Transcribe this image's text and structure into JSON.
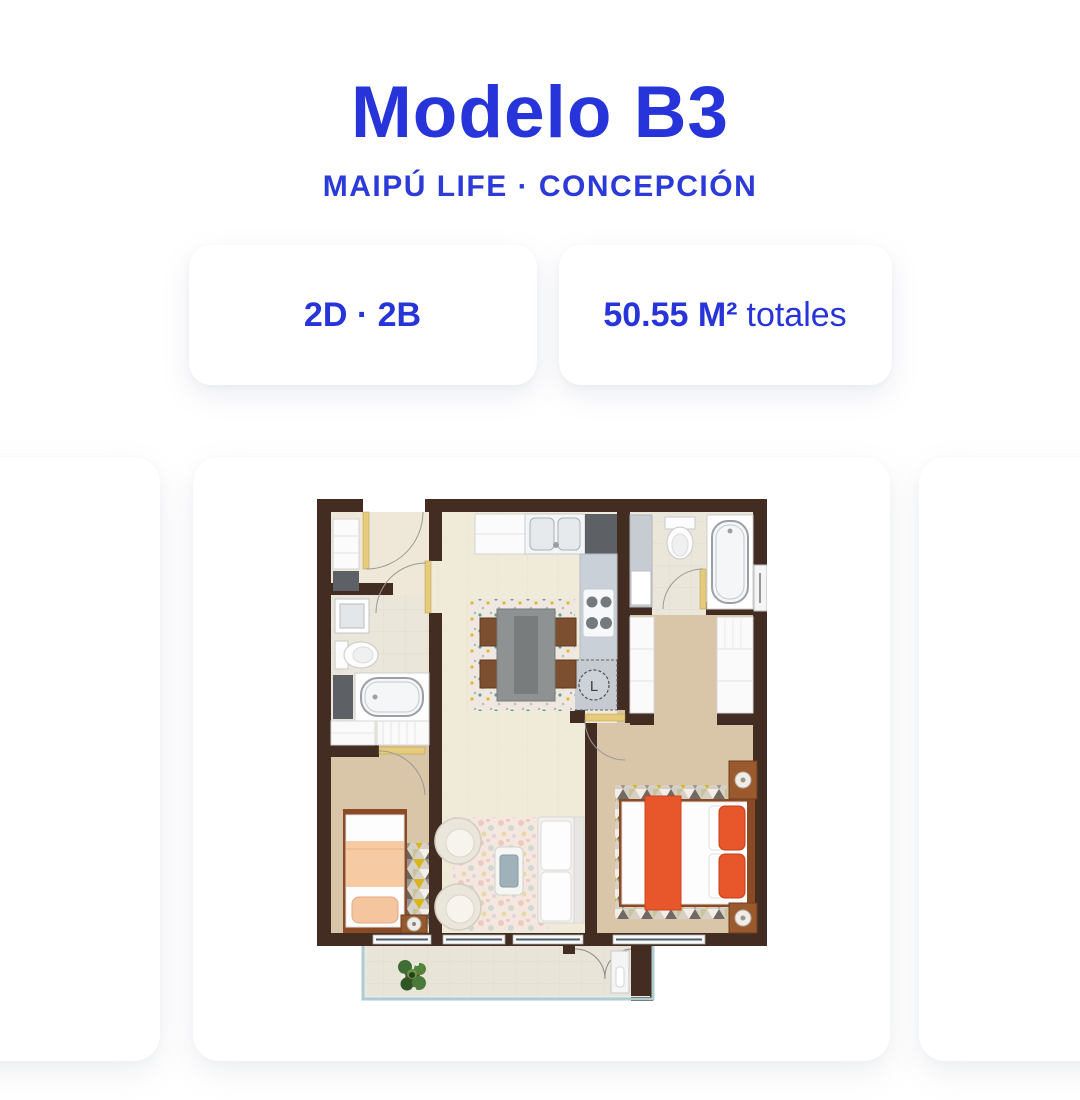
{
  "page": {
    "background": "#ffffff"
  },
  "header": {
    "title": "Modelo B3",
    "subtitle": "MAIPÚ LIFE · CONCEPCIÓN",
    "text_color": "#2634d9"
  },
  "badges": {
    "rooms": {
      "label": "2D · 2B"
    },
    "area": {
      "value": "50.55 M²",
      "suffix": "totales"
    }
  },
  "carousel": {
    "floorplan": {
      "washer_label": "L",
      "colors": {
        "wall": "#432d22",
        "floor_main": "#f0ead9",
        "floor_carpet": "#d9c5a7",
        "floor_bath": "#eae6da",
        "floor_balcony": "#e8e4d7",
        "door_leaf": "#e6cb7a",
        "bed_orange": "#e8562b",
        "bed_peach": "#f6caa2",
        "counter_gray": "#cad0d7",
        "rug_yellow": "#d9b41c",
        "railing_teal": "#aecdd0",
        "wood_brown": "#8a4a26"
      }
    }
  }
}
